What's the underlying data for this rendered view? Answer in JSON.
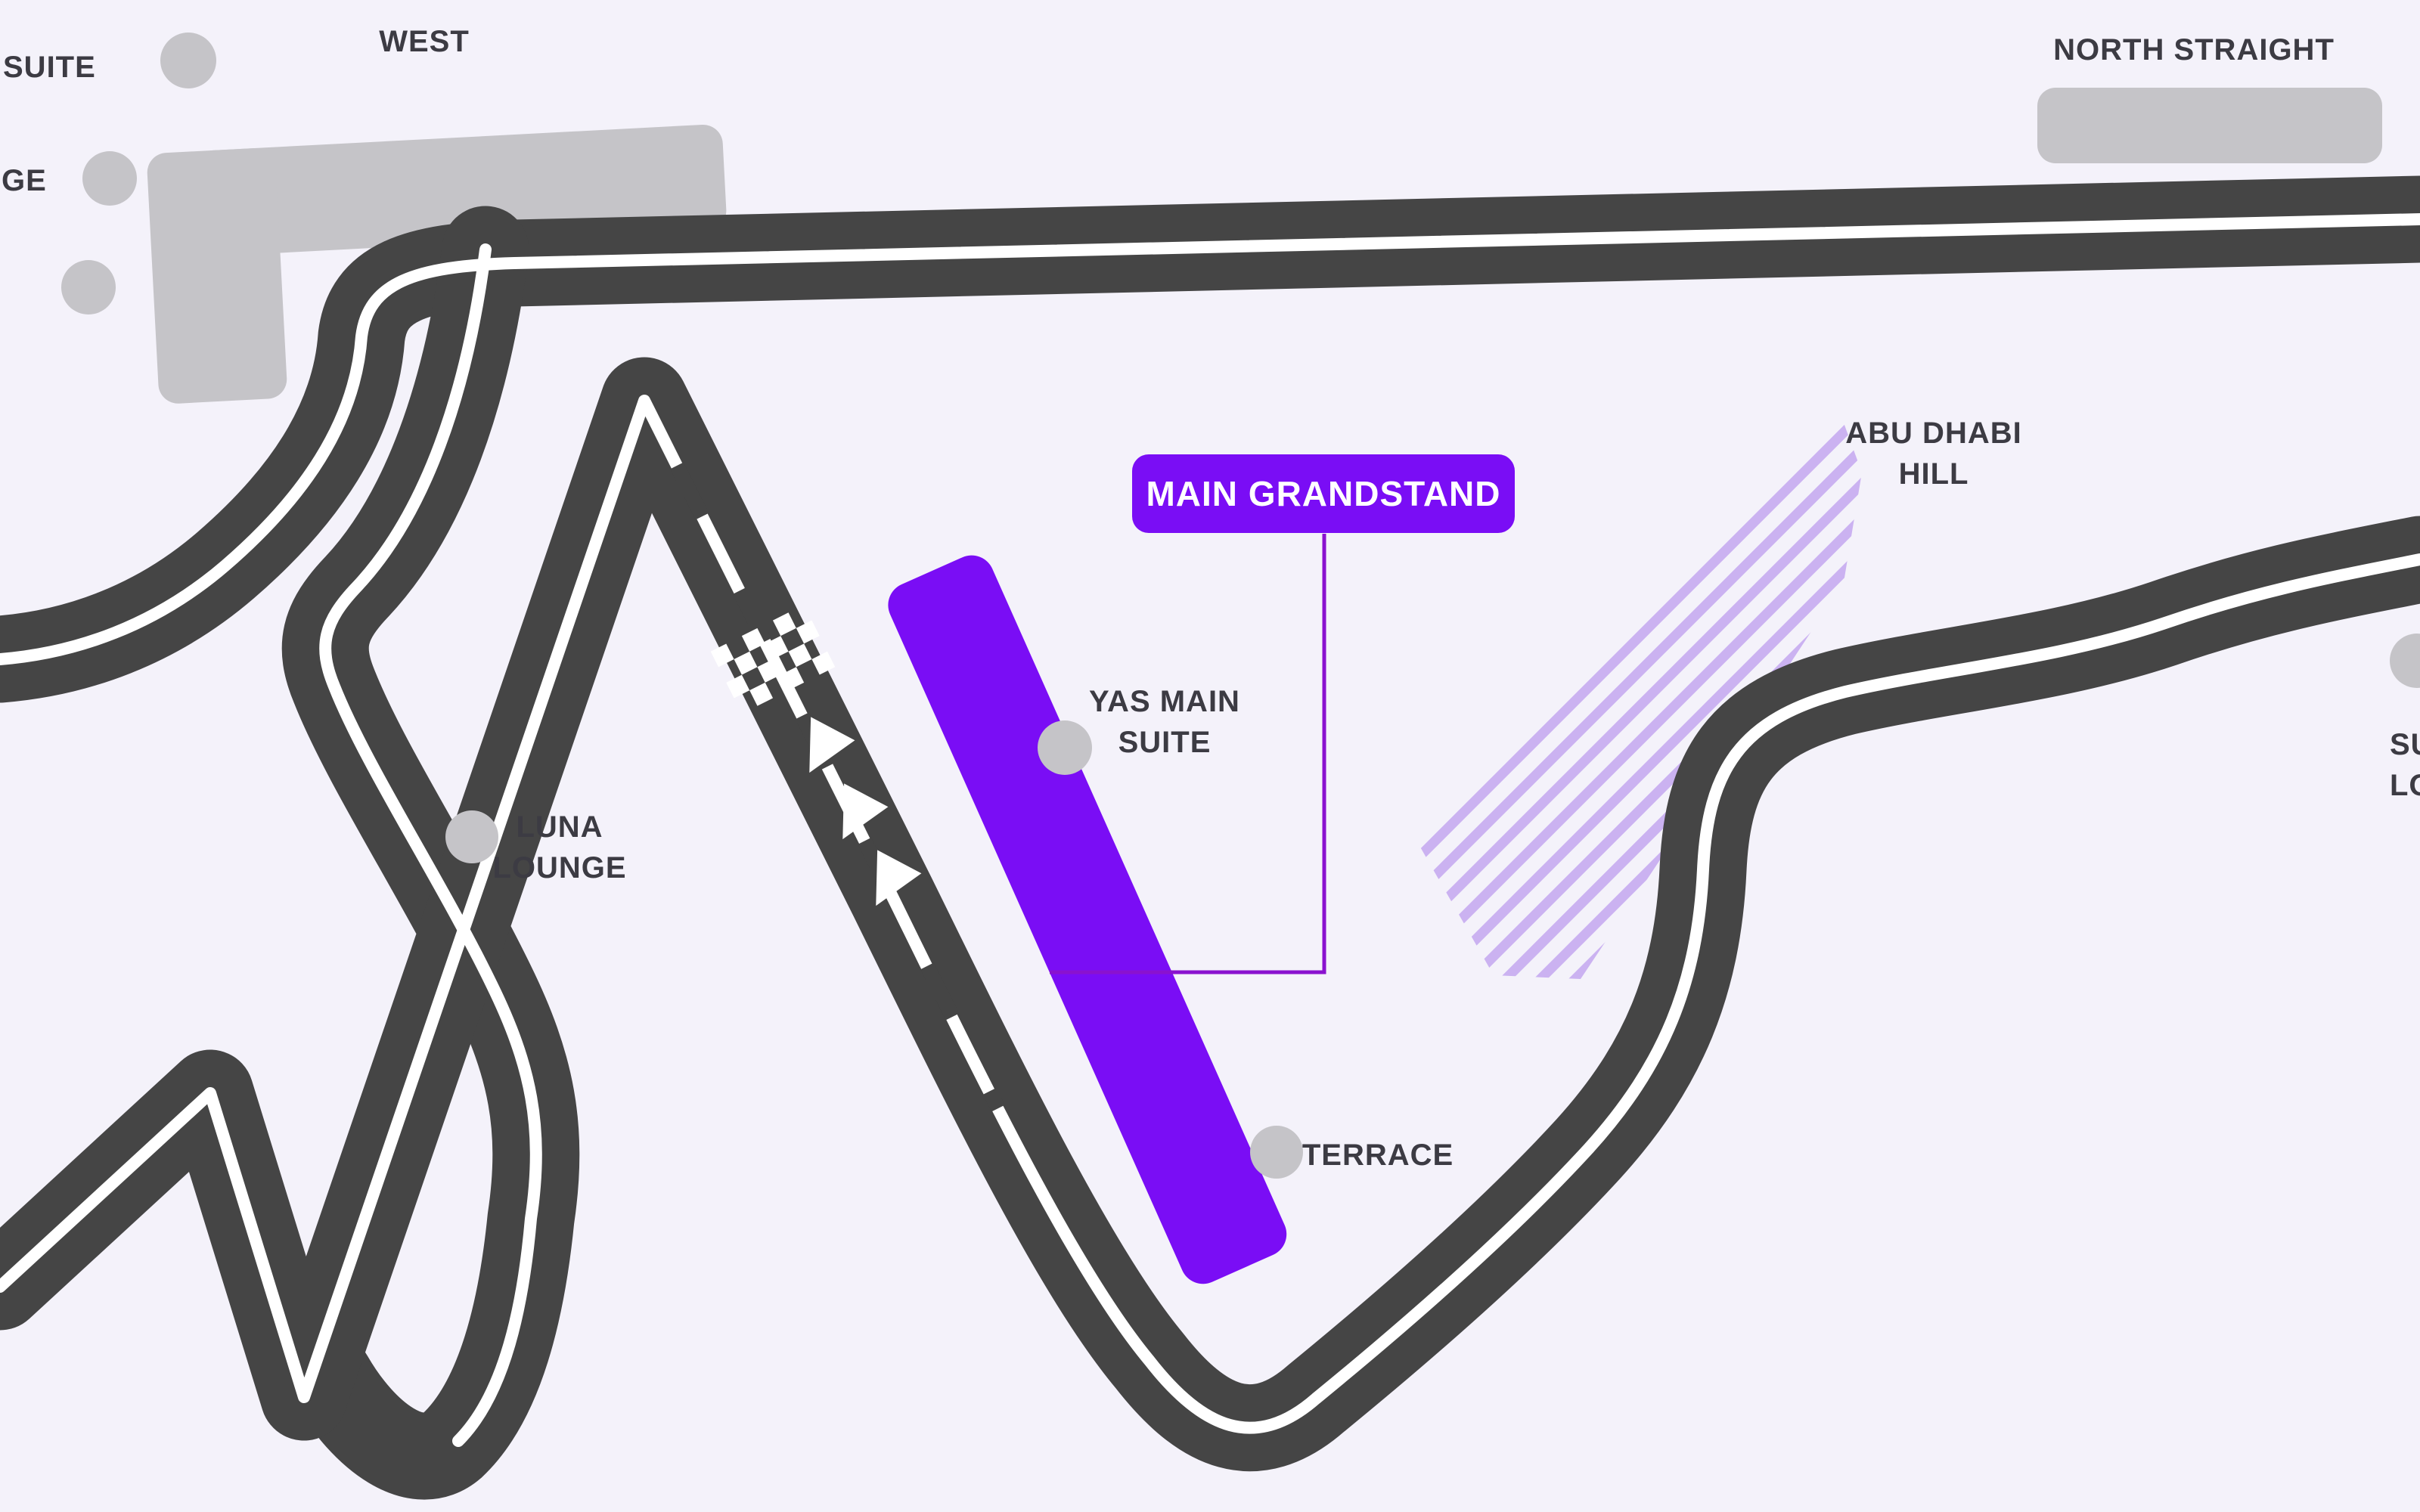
{
  "theme": {
    "bg": "#f4f2fa",
    "track": "#454545",
    "line": "#ffffff",
    "stand": "#c5c4c8",
    "label": "#3c3b43",
    "accent": "#7a0df5",
    "connector": "#8a12cf",
    "hatch": "#cbb2f1"
  },
  "selected_zone": {
    "label": "MAIN GRANDSTAND"
  },
  "zones": {
    "west": {
      "label": "WEST"
    },
    "north_straight": {
      "label": "NORTH STRAIGHT"
    },
    "suite_cut": {
      "label": "SUITE"
    },
    "lounge_cut": {
      "label": "GE"
    },
    "yas_main_suite": {
      "line1": "YAS MAIN",
      "line2": "SUITE"
    },
    "luna_lounge": {
      "line1": "LUNA",
      "line2": "LOUNGE"
    },
    "terrace": {
      "label": "TERRACE"
    },
    "abu_dhabi_hill": {
      "line1": "ABU DHABI",
      "line2": "HILL"
    },
    "right_cut": {
      "line1": "SU",
      "line2": "LO"
    }
  },
  "icons": {
    "markers": "location-dot",
    "start_finish": "checkered-line",
    "direction": "track-arrows"
  }
}
